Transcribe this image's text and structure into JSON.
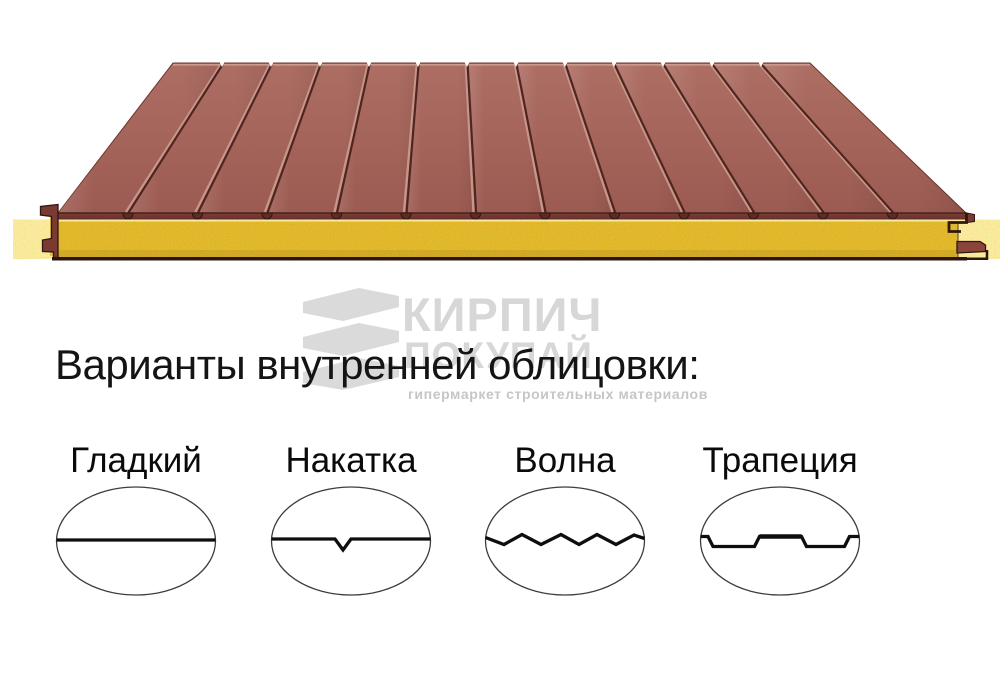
{
  "page": {
    "background_color": "#ffffff"
  },
  "panel_image": {
    "rib_count": 12,
    "sheet_color_back": "#ad6e64",
    "sheet_color_front": "#9c5b52",
    "sheet_outline_color": "#6e352c",
    "back_edge_highlight_color": "#cb9a8d",
    "groove_color": "#50251f",
    "groove_highlight_color": "#c7968a",
    "front_edge_color": "#7d4038",
    "front_edge_color_dark": "#5c2b24",
    "core_color": "#e6c94e",
    "core_side_color": "#e0c043",
    "outline_color": "#2f1712",
    "bottom_bar_color": "#2c150c",
    "end_metal_color": "#7b3a31"
  },
  "watermark": {
    "brand": "КИРПИЧ",
    "brand_line2": "ПОКУПАЙ",
    "tagline": "гипермаркет строительных материалов",
    "brand_color": "#d7d7d7",
    "mark_color": "#dadada",
    "tagline_color": "#c6c6c6"
  },
  "headline": {
    "text": "Варианты внутренней облицовки:",
    "color": "#141414"
  },
  "options": [
    {
      "label": "Гладкий",
      "profile": "smooth"
    },
    {
      "label": "Накатка",
      "profile": "knurl"
    },
    {
      "label": "Волна",
      "profile": "wave"
    },
    {
      "label": "Трапеция",
      "profile": "trapeze"
    }
  ],
  "diagram": {
    "ellipse_outline_color": "#3d3d3d",
    "profile_line_color": "#0e0e0e",
    "label_color": "#0a0a0a"
  }
}
